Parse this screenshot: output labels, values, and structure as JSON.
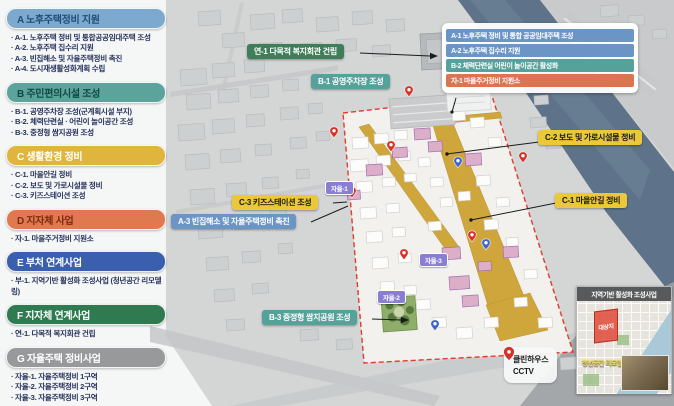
{
  "sidebar": {
    "sections": [
      {
        "title": "A 노후주택정비 지원",
        "items": [
          "A-1. 노후주택 정비 및 통합공공임대주택 조성",
          "A-2. 노후주택 집수리 지원",
          "A-3. 빈집해소 및 자율주택정비 촉진",
          "A-4. 도시재생활성화계획 수립"
        ]
      },
      {
        "title": "B 주민편의시설 조성",
        "items": [
          "B-1. 공영주차장 조성(군계획시설 부지)",
          "B-2. 체력단련실 · 어린이 놀이공간 조성",
          "B-3. 중정형 쌈지공원 조성"
        ]
      },
      {
        "title": "C 생활환경 정비",
        "items": [
          "C-1. 마을안길 정비",
          "C-2. 보도 및 가로시설물 정비",
          "C-3. 키즈스테이션 조성"
        ]
      },
      {
        "title": "D 지자체 사업",
        "items": [
          "자-1. 마을주거정비 지원소"
        ]
      },
      {
        "title": "E 부처 연계사업",
        "items": [
          "부-1. 지역기반 활성화 조성사업 (청년공간 리모델링)"
        ]
      },
      {
        "title": "F 지자체 연계사업",
        "items": [
          "연-1. 다목적 복지회관 건립"
        ]
      },
      {
        "title": "G 자율주택 정비사업",
        "items": [
          "자율-1. 자율주택정비 1구역",
          "자율-2. 자율주택정비 2구역",
          "자율-3. 자율주택정비 3구역"
        ]
      }
    ]
  },
  "map": {
    "callouts": {
      "yeon1": "연-1 다목적 복지회관 건립",
      "b1": "B-1 공영주차장 조성",
      "c2": "C-2 보도 및 가로시설물 정비",
      "c1": "C-1 마을안길 정비",
      "c3": "C-3 키즈스테이션 조성",
      "a3": "A-3 빈집해소 및 자율주택정비 촉진",
      "b3": "B-3 중정형 쌈지공원 조성"
    },
    "info_box": {
      "rows": [
        "A-1 노후주택 정비 및 통합 공공임대주택 조성",
        "A-2 노후주택 집수리 지원",
        "B-2 체력단련실 어린이 놀이공간 활성화",
        "자-1 마을주거정비 지원소"
      ]
    },
    "badges": [
      "자율-1",
      "자율-2",
      "자율-3"
    ],
    "legend": {
      "items": [
        {
          "label": "클린하우스",
          "color": "#3d63cc"
        },
        {
          "label": "CCTV",
          "color": "#d63127"
        }
      ]
    },
    "inset": {
      "title": "지역기반 활성화 조성사업",
      "area_label": "대상지",
      "sub_label": "청년공간 리모델링"
    }
  },
  "colors": {
    "section_a": "#7ea9cf",
    "section_b": "#5ca39b",
    "section_c": "#dfb53e",
    "section_d": "#e0794f",
    "section_e": "#3a5fae",
    "section_f": "#2f7a50",
    "section_g": "#97999b",
    "site_boundary": "#e23b2d",
    "road_yellow": "#cfa63c",
    "river": "#5e7389",
    "badge_purple": "#8a7ed2",
    "callout_yellow": "#eac838"
  }
}
